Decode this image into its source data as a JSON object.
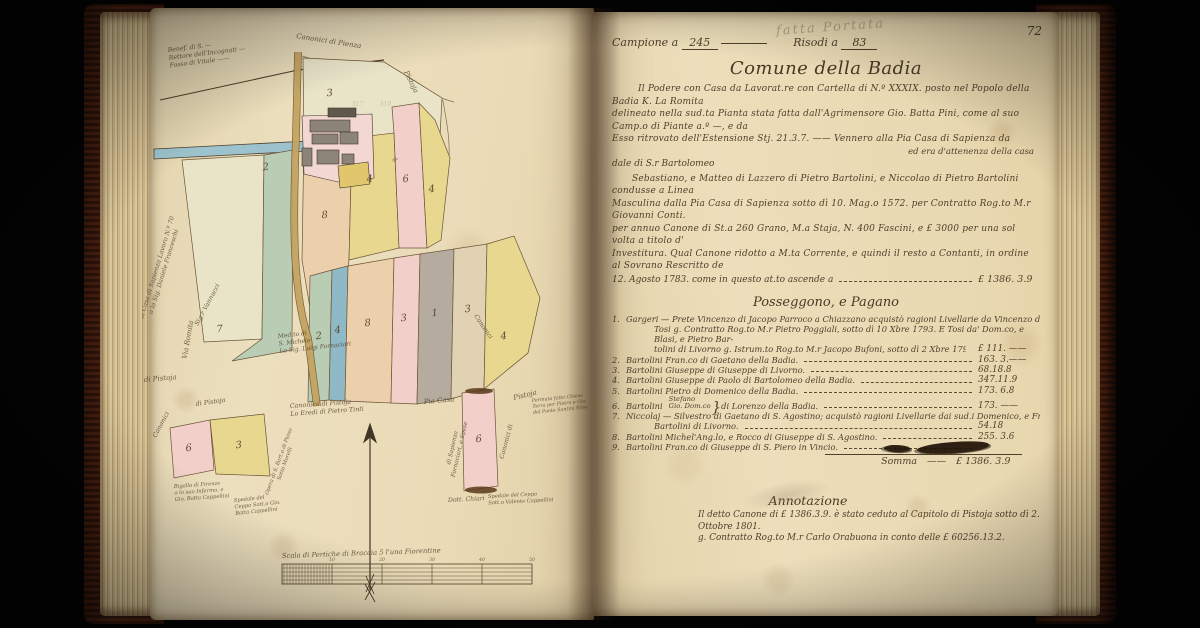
{
  "book": {
    "page_number": "72",
    "pencil_note": "fatta Portata"
  },
  "right_page": {
    "header": {
      "campione_label": "Campione a",
      "campione_value": "245",
      "risodi_label": "Risodi a",
      "risodi_value": "83"
    },
    "title": "Comune della Badia",
    "intro": {
      "lines": [
        "Il Podere con Casa da Lavorat.re con Cartella di N.º XXXIX. posto nel Popolo della Badia K. La Romita",
        "delineato nella sud.ta Pianta stata fatta dall'Agrimensore Gio. Batta Pini, come al suo Camp.o di Piante a.º —, e da",
        "Esso ritrovato dell'Estensione Stj. 21.3.7. —— Vennero alla Pia Casa di Sapienza da"
      ],
      "side_note": "ed era d'attenenza della casa",
      "sub_line": "dale di S.r Bartolomeo"
    },
    "contract": {
      "lines": [
        "Sebastiano, e Matteo di Lazzero di Pietro Bartolini, e Niccolao di Pietro Bartolini condusse a Linea",
        "Masculina dalla Pia Casa di Sapienza sotto dì 10. Mag.o 1572. per Contratto Rog.to M.r Giovanni Conti.",
        "per annuo Canone di St.a 260 Grano, M.a Staja, N. 400 Fascini, e £ 3000 per una sol volta a titolo d'",
        "Investitura. Qual Canone ridotto a M.ta Corrente, e quindi il resto a Contanti, in ordine al Sovrano Rescritto de"
      ],
      "last_line": "12. Agosto 1783. come in questo at.to ascende a",
      "amount": "£ 1386. 3.9"
    },
    "ledger": {
      "heading": "Posseggono, e Pagano",
      "rows": [
        {
          "num": "1.",
          "name": "Gargeri —",
          "lines": [
            "Prete Vincenzo di Jacopo Parroco a Chiazzano acquistò ragioni Livellarie da Vincenzo di Piero",
            "Tosi g. Contratto Rog.to M.r Pietro Poggiali, sotto dì 10 Xbre 1793. E Tosi da' Dom.co, e Blasi, e Pietro Bar-",
            "tolini di Livorno g. Istrum.to Rog.to M.r Jacopo Bufoni, sotto dì 2 Xbre 1794."
          ],
          "amount": "£ 111. ——"
        },
        {
          "num": "2.",
          "name": "Bartolini Fran.co di Gaetano della Badia.",
          "amount": "163. 3.——"
        },
        {
          "num": "3.",
          "name": "Bartolini Giuseppe di Giuseppe di Livorno.",
          "amount": "68.18.8"
        },
        {
          "num": "4.",
          "name": "Bartolini Giuseppe di Paolo di Bartolomeo della Badia.",
          "amount": "347.11.9"
        },
        {
          "num": "5.",
          "name": "Bartolini Pietro di Domenico della Badia.",
          "amount": "173. 6.8"
        },
        {
          "num": "6.",
          "name": "Bartolini",
          "brace_names": [
            "Stefano",
            "Gio. Dom.co"
          ],
          "suffix": "di Lorenzo della Badia.",
          "amount": "173. ——"
        },
        {
          "num": "7.",
          "name": "Niccolaj —",
          "lines": [
            "Silvestro di Gaetano di S. Agostino; acquistò ragioni Livellarie dai sud.i Domenico, e Fran.co",
            "Bartolini di Livorno."
          ],
          "amount": "54.18"
        },
        {
          "num": "8.",
          "name": "Bartolini Michel'Ang.lo, e Rocco di Giuseppe di S. Agostino.",
          "amount": "255. 3.6"
        },
        {
          "num": "9.",
          "name": "Bartolini Fran.co di Giuseppe di S. Piero in Vincio.",
          "amount": "",
          "blot": true
        }
      ],
      "total_label": "Somma",
      "total_dashes": "——",
      "total_amount": "£ 1386. 3.9"
    },
    "annotation": {
      "title": "Annotazione",
      "lines": [
        "Il detto Canone di £ 1386.3.9. è stato ceduto al Capitolo di Pistoja sotto dì 2. Ottobre 1801.",
        "g. Contratto Rog.to M.r Carlo Orabuona in conto delle £ 60256.13.2."
      ]
    }
  },
  "map": {
    "colors": {
      "green": "#b9ccb4",
      "blue": "#8fb9c6",
      "canal": "#9cc3cd",
      "yellow": "#e8d88f",
      "cream": "#e9e4c8",
      "pink": "#f2d0c9",
      "peach": "#ecd0ab",
      "tan": "#e0d2b2",
      "gray": "#b5ac9f",
      "road": "#c3a261",
      "ink": "#4f3f2a",
      "building": "#8d8478",
      "roof": "#5f584c",
      "court": "#e2c66e",
      "pinkpatch": "#f2d7d2"
    },
    "parcel_numbers": {
      "p7": "7",
      "p2a": "2",
      "p3a": "3",
      "p8a": "8",
      "p4a": "4",
      "p6a": "6",
      "p4b": "4",
      "p2c": "2",
      "p4c": "4",
      "p8c": "8",
      "p3c": "3",
      "p1c": "1",
      "p3d": "3",
      "p4d": "4",
      "p6e": "6",
      "p3e": "3",
      "p6f": "6"
    },
    "labels": {
      "benef": "Benef. di S. —\nRettore dell'Incognati —\nFosso di Vitale ——",
      "canonici_top": "Canonici di Pienza",
      "pia_casa_vert": "Pia Casa di Sapienza Lavoro N.º 70\no lo Sig. Daniele Franceschi",
      "vannucci": "Sig.r Vannucci",
      "michele": "Med.to di\nS. Michele\nLo Sig. Luigi Fornaciari",
      "via_romita": "Via Romita",
      "pistoja_edge": "Pistoja",
      "il_edge": "il",
      "canonici_edge": "Canonici",
      "di_pistoja_corner": "di Pistoja",
      "canonici_arc1": "Canonici",
      "canonici_arc2": "di Pistoja",
      "canonica_pistoja": "Canonica di Pistoja\nLo Eredi di Pietro Tinti",
      "pia_casa": "Pia Casa",
      "sapienza_vert": "di Sapienza\nFornaciari, e Spese",
      "canonici_vert_right": "Canonici di",
      "pistoja_permuta": "Pistoja",
      "permuta_note": "Permuta fatta Chiesa\nTerra per Pietro e Gio.\ndel Ponte Santini Silva",
      "chiari": "Dott. Chiari",
      "ceppo_right": "Spedale del Ceppo\nSott.o Valente Cappellini",
      "bigallo": "Bigallo di Firenze\no lo suo Infermo, e\nGio. Batta Cappellini",
      "ceppo_left": "Spedale del\nCeppo Sott.o Gio.\nBatta Cappellini",
      "opera_vert": "Opera di S. Bart.o di Piano\nSotto Morelli",
      "scale": "Scala di Pertiche di Braccia 5 l'una Fiorentine"
    },
    "pencil_marks": [
      "317",
      "318"
    ],
    "scale_ticks": [
      "10",
      "20",
      "30",
      "40",
      "50"
    ]
  }
}
